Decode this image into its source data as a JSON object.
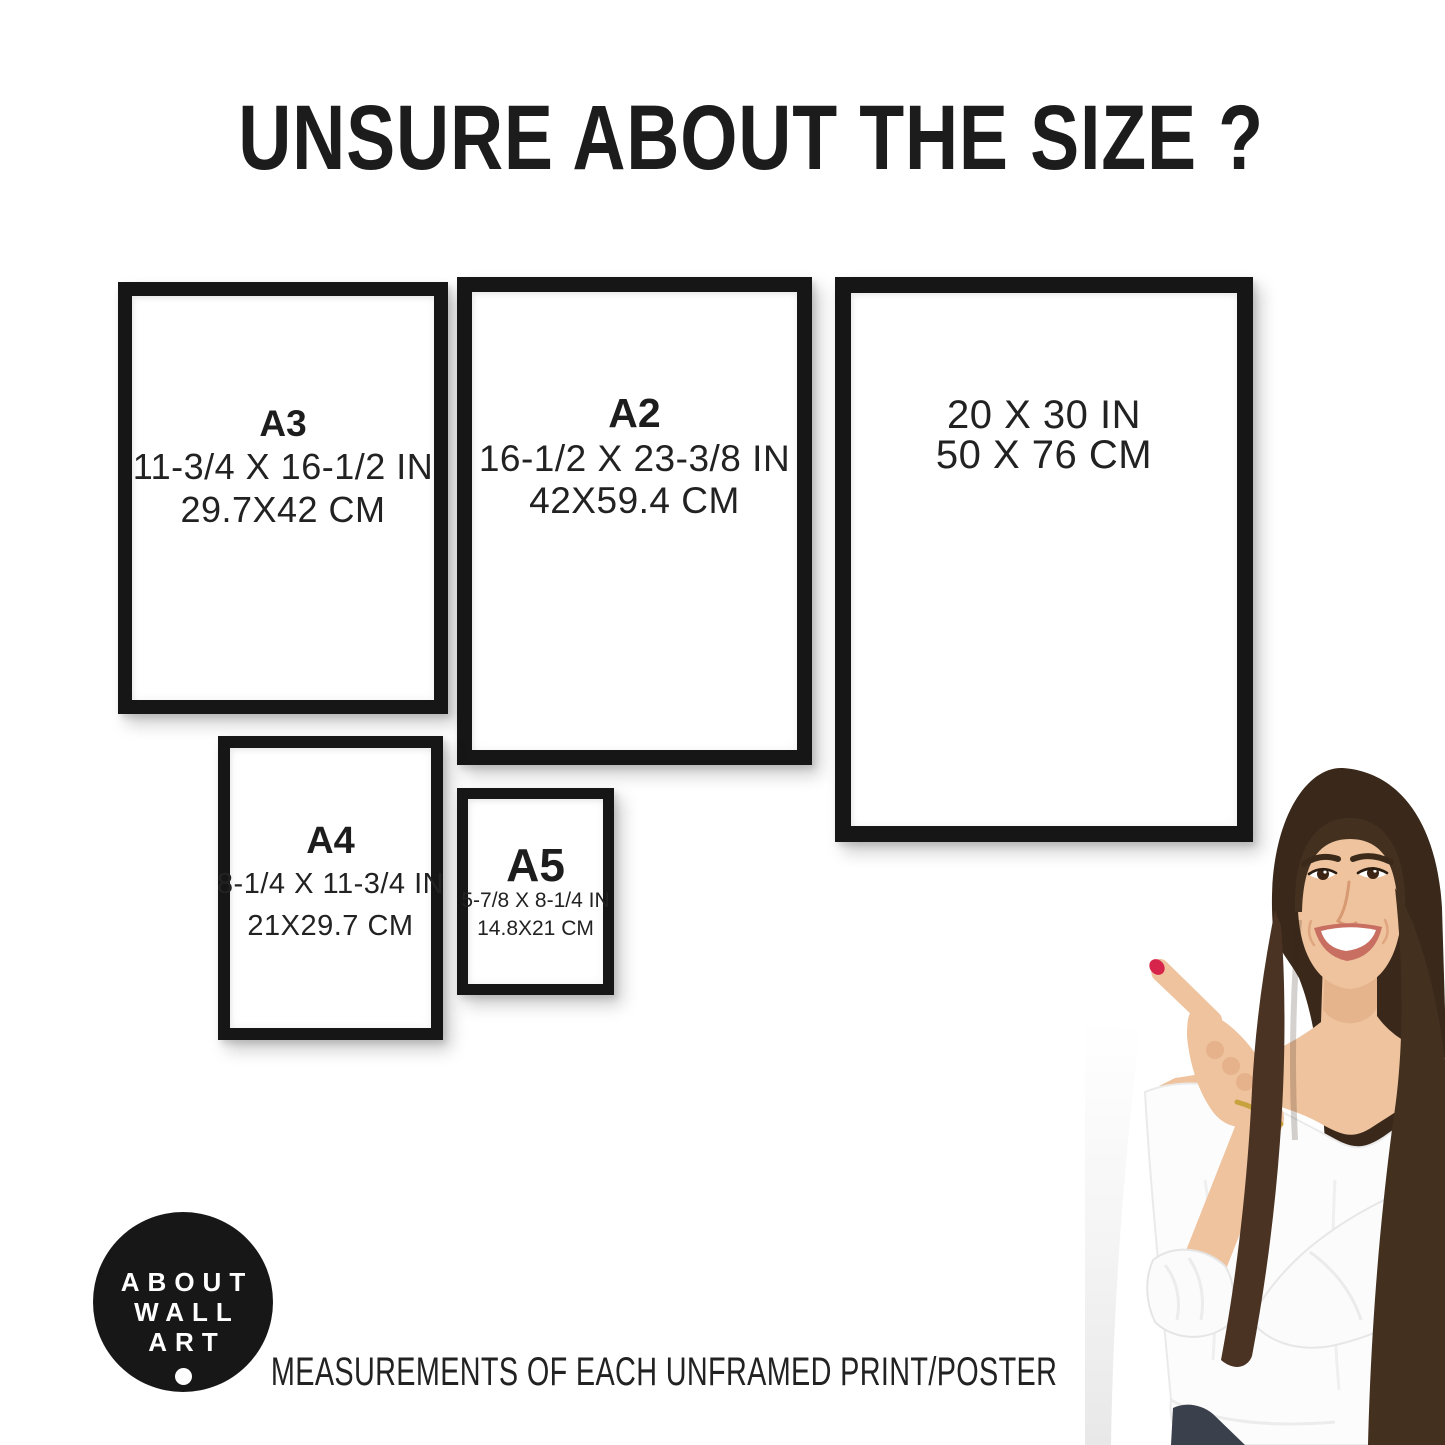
{
  "title": "UNSURE ABOUT THE SIZE ?",
  "frames": {
    "a3": {
      "label": "A3",
      "inches": "11-3/4 X 16-1/2 IN",
      "cm": "29.7X42 CM"
    },
    "a2": {
      "label": "A2",
      "inches": "16-1/2 X 23-3/8 IN",
      "cm": "42X59.4 CM"
    },
    "in20x30": {
      "inches": "20 X 30 IN",
      "cm": "50 X 76 CM"
    },
    "a4": {
      "label": "A4",
      "inches": "8-1/4 X 11-3/4 IN",
      "cm": "21X29.7 CM"
    },
    "a5": {
      "label": "A5",
      "inches": "5-7/8 X 8-1/4 IN",
      "cm": "14.8X21 CM"
    }
  },
  "logo": {
    "line1": "ABOUT",
    "line2": "WALL",
    "line3": "ART"
  },
  "caption": "MEASUREMENTS OF EACH UNFRAMED PRINT/POSTER",
  "colors": {
    "frame_black": "#161616",
    "text": "#1d1d1d",
    "background": "#ffffff",
    "logo_bg": "#171717",
    "logo_text": "#ffffff",
    "hair_brown": "#44301f",
    "skin": "#eec39e",
    "blouse_white": "#fcfcfc",
    "nail_red": "#d6244a",
    "bracelet_gold": "#c8a23c",
    "jeans": "#3a414c"
  }
}
